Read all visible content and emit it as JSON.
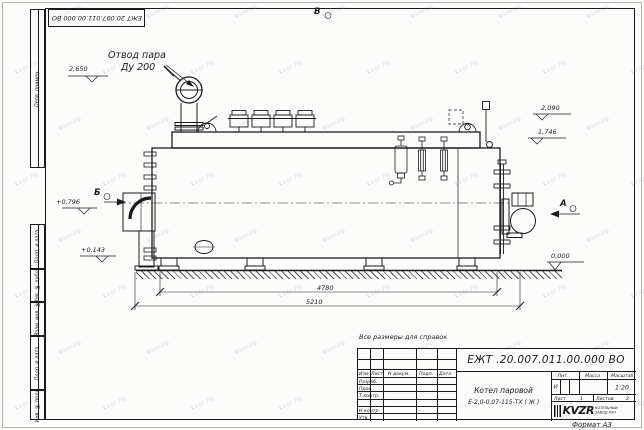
{
  "sheet_frame": {
    "top_stamp": "ЕЖТ 20.007.011.00.000  ВО",
    "format_note": "Формат А3",
    "margin_boxes": [
      "Перв. примен.",
      "Подп. и дата",
      "Инв. № дубл.",
      "Взам. инв. №",
      "Подп. и дата",
      "Инв. № подл."
    ]
  },
  "watermark": {
    "text": "kvzr.ru"
  },
  "drawing": {
    "note": "Все размеры для справок",
    "callout": {
      "line1": "Отвод пара",
      "line2": "Ду 200"
    },
    "views": {
      "top": "В",
      "left": "Б",
      "right": "А"
    },
    "elevations": {
      "steam_outlet": "2,650",
      "top_right_upper": "2,090",
      "top_right_lower": "1,746",
      "burner_axis": "+0,796",
      "lower_left": "+0,143",
      "ground": "0,000"
    },
    "dimensions": {
      "inner_length": "4780",
      "overall_length": "5210"
    }
  },
  "title_block": {
    "doc_number": "ЕЖТ .20.007.011.00.000  ВО",
    "product_line1": "Котел паровой",
    "product_line2": "Е-2,0-0,07-115-ТХ ( Ж )",
    "col_headers": {
      "izm": "Изм.",
      "list": "Лист",
      "doc": "N докум.",
      "sign": "Подп.",
      "date": "Дата"
    },
    "row_labels": {
      "razrab": "Разраб.",
      "prov": "Пров.",
      "tkontr": "Т.контр.",
      "nkontr": "Н.контр.",
      "utv": "Утв."
    },
    "lit_header": "Лит.",
    "mass_header": "Масса",
    "scale_header": "Масштаб",
    "lit_value": "И",
    "scale_value": "1:20",
    "sheet_label": "Лист",
    "sheet_value": "1",
    "sheets_label": "Листов",
    "sheets_value": "2",
    "company": {
      "logo": "KVZR",
      "line1": "КОТЕЛЬНЫЙ",
      "line2": "ЗАВОД РЭП"
    }
  }
}
